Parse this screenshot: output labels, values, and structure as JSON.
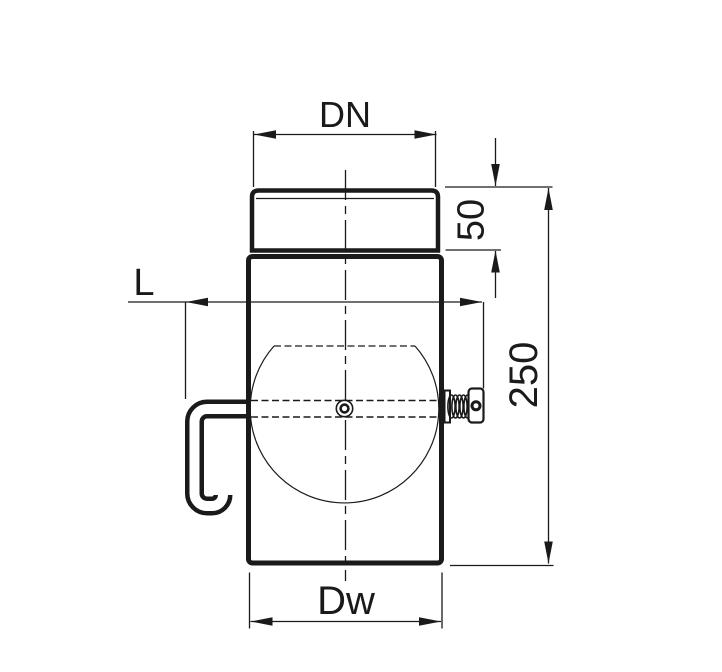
{
  "labels": {
    "dn": "DN",
    "collar_height": "50",
    "total_length": "250",
    "lever_length": "L",
    "dw": "Dw"
  },
  "colors": {
    "line": "#1a1a1a",
    "background": "#ffffff"
  }
}
